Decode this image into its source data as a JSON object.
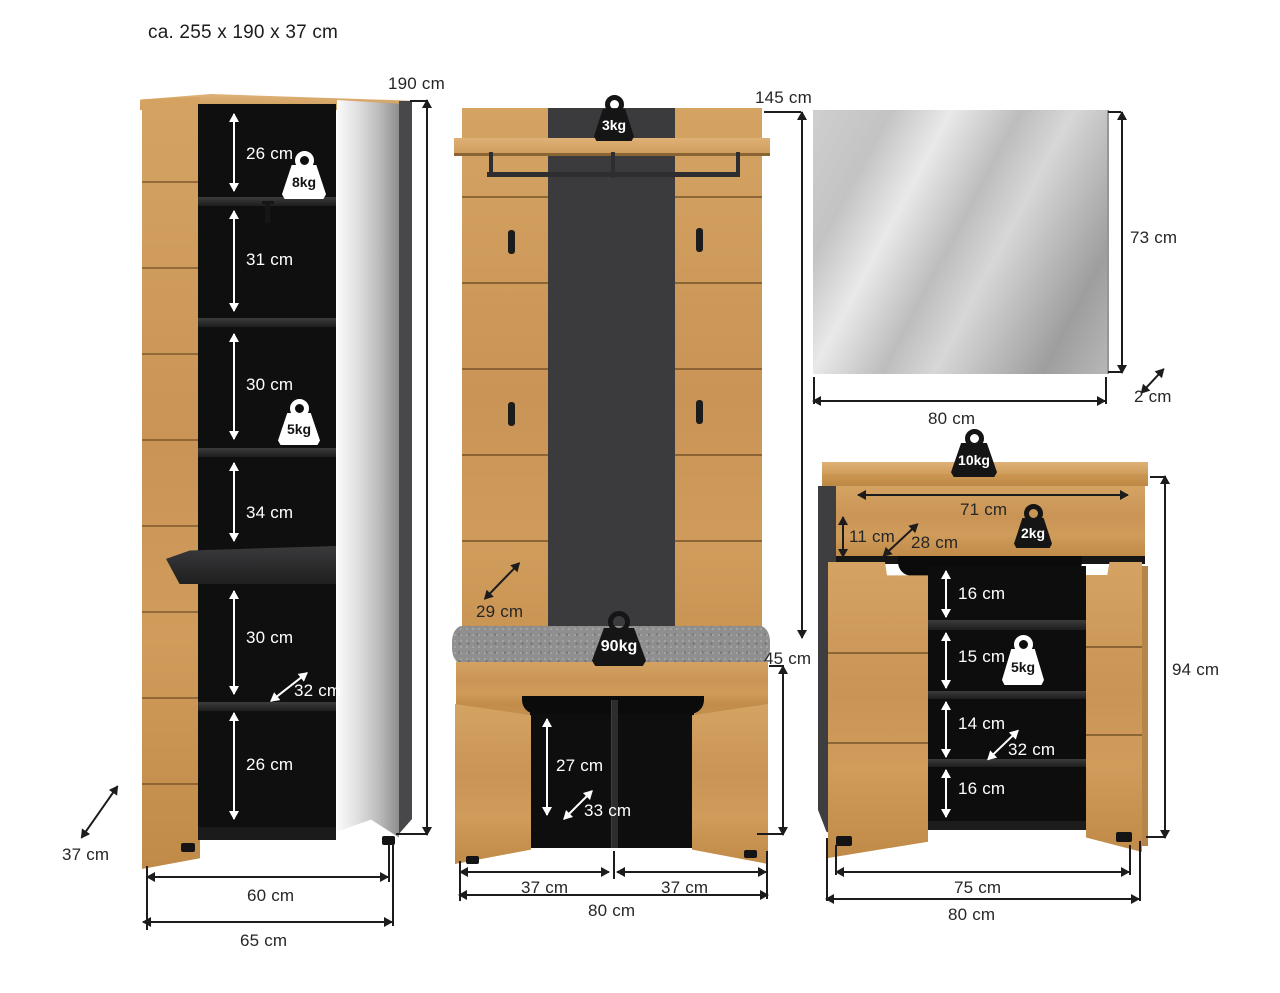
{
  "title": "ca. 255 x 190 x 37 cm",
  "wardrobe": {
    "height": "190 cm",
    "sections": [
      "26 cm",
      "31 cm",
      "30 cm",
      "34 cm",
      "30 cm",
      "26 cm"
    ],
    "inner_depth": "32 cm",
    "top_shelf_capacity": "8kg",
    "mid_shelf_capacity": "5kg",
    "depth": "37 cm",
    "inner_width": "60 cm",
    "width": "65 cm"
  },
  "coatrack": {
    "height": "145 cm",
    "shelf_capacity": "3kg",
    "panel_depth": "29 cm",
    "bench_capacity": "90kg",
    "bench_height": "45 cm",
    "bench_inner_height": "27 cm",
    "bench_inner_depth": "33 cm",
    "left_door_width": "37 cm",
    "right_door_width": "37 cm",
    "width": "80 cm"
  },
  "mirror": {
    "height": "73 cm",
    "width": "80 cm",
    "depth": "2 cm"
  },
  "shoe_cabinet": {
    "top_capacity": "10kg",
    "drawer_width": "71 cm",
    "drawer_height": "11 cm",
    "drawer_depth": "28 cm",
    "drawer_capacity": "2kg",
    "sections": [
      "16 cm",
      "15 cm",
      "14 cm",
      "16 cm"
    ],
    "shelf_capacity": "5kg",
    "inner_depth": "32 cm",
    "height": "94 cm",
    "inner_width": "75 cm",
    "width": "80 cm"
  }
}
